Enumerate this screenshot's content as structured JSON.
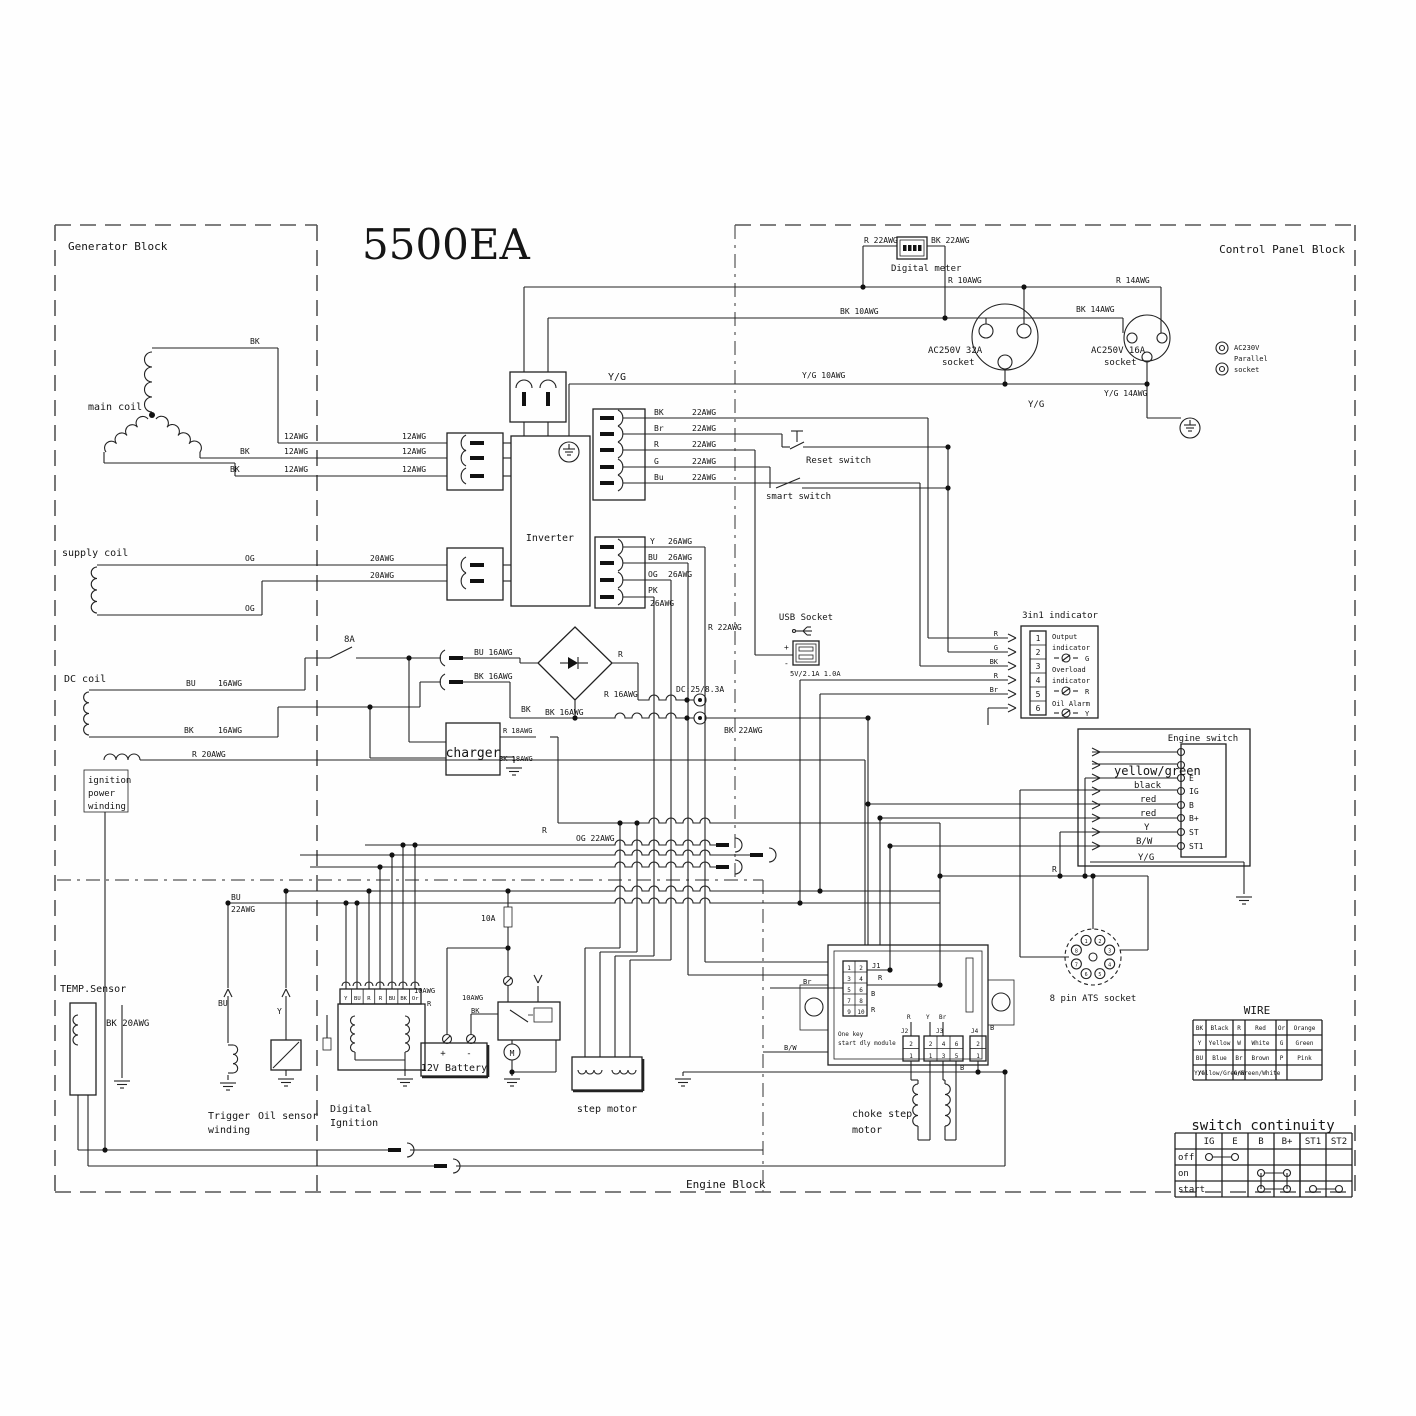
{
  "blocks": {
    "generator": "Generator Block",
    "control_panel": "Control Panel Block",
    "engine": "Engine Block",
    "product": "5500EA"
  },
  "engine_switch": {
    "title": "Engine switch",
    "terminals": [
      "E",
      "IG",
      "B",
      "B+",
      "ST",
      "ST1"
    ],
    "wire_labels": [
      "yellow/green",
      "black",
      "red",
      "red",
      "Y",
      "B/W",
      "Y/G"
    ]
  },
  "indicator": {
    "title": "3in1 indicator",
    "pins": [
      "1",
      "2",
      "3",
      "4",
      "5",
      "6"
    ],
    "wire_labels": [
      "R",
      "G",
      "BK",
      "R",
      "Br"
    ],
    "rows": [
      [
        "Output",
        "indicator"
      ],
      [
        "Overload",
        "indicator"
      ],
      [
        "Oil Alarm"
      ]
    ],
    "leds": [
      "G",
      "R",
      "Y"
    ]
  },
  "module": {
    "name": "One key start dly module",
    "j1_pins": [
      "1",
      "2",
      "3",
      "4",
      "5",
      "6",
      "7",
      "8",
      "9",
      "10"
    ],
    "j2_pins": [
      "2",
      "1"
    ],
    "j3_pins": [
      "2",
      "4",
      "6",
      "1",
      "3",
      "5"
    ],
    "j4_pins": [
      "2",
      "1"
    ]
  },
  "ats": {
    "label": "8 pin ATS socket",
    "pins": [
      "1",
      "2",
      "3",
      "4",
      "5",
      "6",
      "7",
      "8"
    ]
  },
  "ignition": {
    "terminals": [
      "Y",
      "BU",
      "R",
      "R",
      "BU",
      "BK",
      "Or"
    ]
  },
  "wire_table": {
    "title": "WIRE",
    "rows": [
      [
        "BK",
        "Black",
        "R",
        "Red",
        "Or",
        "Orange"
      ],
      [
        "Y",
        "Yellow",
        "W",
        "White",
        "G",
        "Green"
      ],
      [
        "BU",
        "Blue",
        "Br",
        "Brown",
        "P",
        "Pink"
      ],
      [
        "Y/G",
        "Yellow/Green",
        "G/W",
        "Green/White",
        "",
        ""
      ]
    ]
  },
  "continuity_table": {
    "title": "switch continuity",
    "columns": [
      "IG",
      "E",
      "B",
      "B+",
      "ST1",
      "ST2"
    ],
    "rows": [
      "off",
      "on",
      "start"
    ],
    "links": [
      {
        "row": 0,
        "from": "IG",
        "to": "E"
      },
      {
        "row": 1,
        "from": "B",
        "to": "B+"
      },
      {
        "row": 2,
        "from": "B",
        "to": "B+"
      },
      {
        "row": 2,
        "from": "ST1",
        "to": "ST2"
      }
    ],
    "verticals": [
      {
        "col": "B"
      },
      {
        "col": "B+"
      }
    ]
  },
  "labels": [
    {
      "id": "lbl-r22awg-meter",
      "t": "R  22AWG",
      "x": 864,
      "y": 243
    },
    {
      "id": "lbl-bk22awg-meter",
      "t": "BK 22AWG",
      "x": 931,
      "y": 243
    },
    {
      "id": "digital-meter-label",
      "t": "Digital meter",
      "x": 891,
      "y": 271,
      "s": 9
    },
    {
      "id": "lbl-r10awg",
      "t": "R   10AWG",
      "x": 948,
      "y": 283
    },
    {
      "id": "lbl-r14awg",
      "t": "R   14AWG",
      "x": 1116,
      "y": 283
    },
    {
      "id": "lbl-bk10awg",
      "t": "BK   10AWG",
      "x": 840,
      "y": 314
    },
    {
      "id": "lbl-bk14awg",
      "t": "BK   14AWG",
      "x": 1076,
      "y": 312
    },
    {
      "id": "socket32-label1",
      "t": "AC250V 32A",
      "x": 928,
      "y": 353,
      "s": 9
    },
    {
      "id": "socket32-label2",
      "t": "socket",
      "x": 942,
      "y": 365,
      "s": 9
    },
    {
      "id": "socket16-label1",
      "t": "AC250V 16A",
      "x": 1091,
      "y": 353,
      "s": 9
    },
    {
      "id": "socket16-label2",
      "t": "socket",
      "x": 1104,
      "y": 365,
      "s": 9
    },
    {
      "id": "parallel-label1",
      "t": "AC230V",
      "x": 1234,
      "y": 350,
      "s": 7
    },
    {
      "id": "parallel-label2",
      "t": "Parallel",
      "x": 1234,
      "y": 361,
      "s": 7
    },
    {
      "id": "parallel-label3",
      "t": "socket",
      "x": 1234,
      "y": 372,
      "s": 7
    },
    {
      "id": "lbl-yg-inverter",
      "t": "Y/G",
      "x": 608,
      "y": 380,
      "s": 10
    },
    {
      "id": "lbl-yg10awg",
      "t": "Y/G 10AWG",
      "x": 802,
      "y": 378
    },
    {
      "id": "lbl-yg14awg",
      "t": "Y/G 14AWG",
      "x": 1104,
      "y": 396
    },
    {
      "id": "lbl-yg-socket",
      "t": "Y/G",
      "x": 1028,
      "y": 407,
      "s": 9
    },
    {
      "id": "main-coil-label",
      "t": "main coil",
      "x": 88,
      "y": 410,
      "s": 10
    },
    {
      "id": "lbl-bk-main-top",
      "t": "BK",
      "x": 250,
      "y": 344
    },
    {
      "id": "lbl-12awg-1a",
      "t": "12AWG",
      "x": 284,
      "y": 439
    },
    {
      "id": "lbl-12awg-1b",
      "t": "12AWG",
      "x": 402,
      "y": 439
    },
    {
      "id": "lbl-bk-main-2",
      "t": "BK",
      "x": 240,
      "y": 454
    },
    {
      "id": "lbl-12awg-2a",
      "t": "12AWG",
      "x": 284,
      "y": 454
    },
    {
      "id": "lbl-12awg-2b",
      "t": "12AWG",
      "x": 402,
      "y": 454
    },
    {
      "id": "lbl-bk-main-3",
      "t": "BK",
      "x": 230,
      "y": 472
    },
    {
      "id": "lbl-12awg-3a",
      "t": "12AWG",
      "x": 284,
      "y": 472
    },
    {
      "id": "lbl-12awg-3b",
      "t": "12AWG",
      "x": 402,
      "y": 472
    },
    {
      "id": "supply-coil-label",
      "t": "supply coil",
      "x": 62,
      "y": 556,
      "s": 10
    },
    {
      "id": "lbl-og-1",
      "t": "OG",
      "x": 245,
      "y": 561
    },
    {
      "id": "lbl-20awg-1",
      "t": "20AWG",
      "x": 370,
      "y": 561
    },
    {
      "id": "lbl-20awg-2",
      "t": "20AWG",
      "x": 370,
      "y": 578
    },
    {
      "id": "lbl-og-2",
      "t": "OG",
      "x": 245,
      "y": 611
    },
    {
      "id": "lbl-8a",
      "t": "8A",
      "x": 344,
      "y": 642,
      "s": 9
    },
    {
      "id": "dc-coil-label",
      "t": "DC coil",
      "x": 64,
      "y": 682,
      "s": 10
    },
    {
      "id": "lbl-bu-dc",
      "t": "BU",
      "x": 186,
      "y": 686
    },
    {
      "id": "lbl-16awg-dc1",
      "t": "16AWG",
      "x": 218,
      "y": 686
    },
    {
      "id": "lbl-bk-dc",
      "t": "BK",
      "x": 184,
      "y": 733
    },
    {
      "id": "lbl-16awg-dc2",
      "t": "16AWG",
      "x": 218,
      "y": 733
    },
    {
      "id": "lbl-bu16awg",
      "t": "BU  16AWG",
      "x": 474,
      "y": 655
    },
    {
      "id": "lbl-bk16awg-conn",
      "t": "BK  16AWG",
      "x": 474,
      "y": 679
    },
    {
      "id": "lbl-r-bridge",
      "t": "R",
      "x": 618,
      "y": 657
    },
    {
      "id": "lbl-r16awg",
      "t": "R  16AWG",
      "x": 604,
      "y": 697
    },
    {
      "id": "lbl-bk-bridge",
      "t": "BK",
      "x": 521,
      "y": 712
    },
    {
      "id": "lbl-bk16awg-2",
      "t": "BK  16AWG",
      "x": 545,
      "y": 715
    },
    {
      "id": "lbl-dc-rating",
      "t": "DC:25/8.3A",
      "x": 676,
      "y": 692
    },
    {
      "id": "lbl-bk22awg-dc",
      "t": "BK 22AWG",
      "x": 724,
      "y": 733
    },
    {
      "id": "charger-label",
      "t": "charger",
      "x": 473,
      "y": 757,
      "s": 13,
      "a": "middle"
    },
    {
      "id": "lbl-r18awg",
      "t": "R 18AWG",
      "x": 503,
      "y": 733,
      "s": 7
    },
    {
      "id": "lbl-bk18awg",
      "t": "BK 18AWG",
      "x": 499,
      "y": 761,
      "s": 7
    },
    {
      "id": "ignition-winding-1",
      "t": "ignition",
      "x": 88,
      "y": 783,
      "s": 9
    },
    {
      "id": "ignition-winding-2",
      "t": "power",
      "x": 88,
      "y": 796,
      "s": 9
    },
    {
      "id": "ignition-winding-3",
      "t": "winding",
      "x": 88,
      "y": 809,
      "s": 9
    },
    {
      "id": "lbl-r20awg",
      "t": "R   20AWG",
      "x": 192,
      "y": 757
    },
    {
      "id": "lbl-og22awg",
      "t": "OG  22AWG",
      "x": 576,
      "y": 841
    },
    {
      "id": "lbl-r-bundle",
      "t": "R",
      "x": 542,
      "y": 833
    },
    {
      "id": "lbl-10a",
      "t": "10A",
      "x": 481,
      "y": 921
    },
    {
      "id": "usb-title",
      "t": "USB Socket",
      "x": 806,
      "y": 620,
      "s": 9,
      "a": "middle"
    },
    {
      "id": "lbl-r22awg-usb",
      "t": "R  22AWG",
      "x": 708,
      "y": 630
    },
    {
      "id": "usb-rating",
      "t": "5V/2.1A 1.0A",
      "x": 790,
      "y": 676,
      "s": 7
    },
    {
      "id": "usb-plus",
      "t": "+",
      "x": 784,
      "y": 650,
      "s": 8
    },
    {
      "id": "usb-minus",
      "t": "-",
      "x": 784,
      "y": 666,
      "s": 8
    },
    {
      "id": "lbl-r-ats",
      "t": "R",
      "x": 1052,
      "y": 872
    },
    {
      "id": "ats-label",
      "t": "8 pin ATS socket",
      "x": 1093,
      "y": 1001,
      "s": 9,
      "a": "middle"
    },
    {
      "id": "temp-sensor-label",
      "t": "TEMP.Sensor",
      "x": 60,
      "y": 992,
      "s": 10
    },
    {
      "id": "lbl-bk20awg",
      "t": "BK  20AWG",
      "x": 106,
      "y": 1026,
      "s": 9
    },
    {
      "id": "lbl-bu-trigger",
      "t": "BU",
      "x": 218,
      "y": 1006
    },
    {
      "id": "lbl-y-oil",
      "t": "Y",
      "x": 277,
      "y": 1014
    },
    {
      "id": "trigger-label-1",
      "t": "Trigger",
      "x": 208,
      "y": 1119,
      "s": 10
    },
    {
      "id": "trigger-label-2",
      "t": "winding",
      "x": 208,
      "y": 1133,
      "s": 10
    },
    {
      "id": "oil-sensor-label",
      "t": "Oil sensor",
      "x": 258,
      "y": 1119,
      "s": 10
    },
    {
      "id": "digital-ignition-label-1",
      "t": "Digital",
      "x": 330,
      "y": 1112,
      "s": 10
    },
    {
      "id": "digital-ignition-label-2",
      "t": "Ignition",
      "x": 330,
      "y": 1126,
      "s": 10
    },
    {
      "id": "lbl-10awg-batt",
      "t": "10AWG",
      "x": 414,
      "y": 993,
      "s": 7
    },
    {
      "id": "lbl-r-batt",
      "t": "R",
      "x": 427,
      "y": 1006,
      "s": 7
    },
    {
      "id": "lbl-10awg-relay",
      "t": "10AWG",
      "x": 462,
      "y": 1000,
      "s": 7
    },
    {
      "id": "lbl-bk-relay",
      "t": "BK",
      "x": 471,
      "y": 1013,
      "s": 7
    },
    {
      "id": "battery-plus",
      "t": "+",
      "x": 443,
      "y": 1056,
      "s": 9,
      "a": "middle"
    },
    {
      "id": "battery-minus",
      "t": "-",
      "x": 469,
      "y": 1056,
      "s": 9,
      "a": "middle"
    },
    {
      "id": "battery-label",
      "t": "12V Battery",
      "x": 454,
      "y": 1071,
      "s": 10,
      "a": "middle"
    },
    {
      "id": "motor-m",
      "t": "M",
      "x": 512,
      "y": 1056,
      "s": 8,
      "a": "middle"
    },
    {
      "id": "step-motor-label",
      "t": "step motor",
      "x": 607,
      "y": 1112,
      "s": 10,
      "a": "middle"
    },
    {
      "id": "choke-label-1",
      "t": "choke step",
      "x": 852,
      "y": 1117,
      "s": 10
    },
    {
      "id": "choke-label-2",
      "t": "motor",
      "x": 852,
      "y": 1133,
      "s": 10
    },
    {
      "id": "onekey-label-1",
      "t": "One key",
      "x": 838,
      "y": 1036,
      "s": 6
    },
    {
      "id": "onekey-label-2",
      "t": "start dly module",
      "x": 838,
      "y": 1045,
      "s": 6
    },
    {
      "id": "lbl-j1",
      "t": "J1",
      "x": 872,
      "y": 968,
      "s": 7
    },
    {
      "id": "lbl-j1-r1",
      "t": "R",
      "x": 878,
      "y": 980,
      "s": 7
    },
    {
      "id": "lbl-j1-b",
      "t": "B",
      "x": 871,
      "y": 996,
      "s": 7
    },
    {
      "id": "lbl-j1-r2",
      "t": "R",
      "x": 871,
      "y": 1012,
      "s": 7
    },
    {
      "id": "lbl-br-module",
      "t": "Br",
      "x": 803,
      "y": 984,
      "s": 7
    },
    {
      "id": "lbl-bw-module",
      "t": "B/W",
      "x": 784,
      "y": 1050,
      "s": 7
    },
    {
      "id": "lbl-j2",
      "t": "J2",
      "x": 901,
      "y": 1033,
      "s": 6
    },
    {
      "id": "lbl-j3",
      "t": "J3",
      "x": 936,
      "y": 1033,
      "s": 6
    },
    {
      "id": "lbl-j4",
      "t": "J4",
      "x": 971,
      "y": 1033,
      "s": 6
    },
    {
      "id": "lbl-r-conn",
      "t": "R",
      "x": 907,
      "y": 1019,
      "s": 6
    },
    {
      "id": "lbl-y-conn",
      "t": "Y",
      "x": 926,
      "y": 1019,
      "s": 6
    },
    {
      "id": "lbl-br-conn",
      "t": "Br",
      "x": 939,
      "y": 1019,
      "s": 6
    },
    {
      "id": "lbl-b-conn1",
      "t": "B",
      "x": 990,
      "y": 1030,
      "s": 7
    },
    {
      "id": "lbl-b-conn2",
      "t": "B",
      "x": 960,
      "y": 1070,
      "s": 7
    },
    {
      "id": "lbl-bu22-1",
      "t": "BU",
      "x": 231,
      "y": 900
    },
    {
      "id": "lbl-bu22-2",
      "t": "22AWG",
      "x": 231,
      "y": 912
    },
    {
      "id": "inverter-label",
      "t": "Inverter",
      "x": 550,
      "y": 541,
      "s": 10,
      "a": "middle"
    },
    {
      "id": "lbl-w1c",
      "t": "BK",
      "x": 654,
      "y": 415
    },
    {
      "id": "lbl-w1g",
      "t": "22AWG",
      "x": 692,
      "y": 415
    },
    {
      "id": "lbl-w2c",
      "t": "Br",
      "x": 654,
      "y": 431
    },
    {
      "id": "lbl-w2g",
      "t": "22AWG",
      "x": 692,
      "y": 431
    },
    {
      "id": "lbl-w3c",
      "t": "R",
      "x": 654,
      "y": 447
    },
    {
      "id": "lbl-w3g",
      "t": "22AWG",
      "x": 692,
      "y": 447
    },
    {
      "id": "lbl-w4c",
      "t": "G",
      "x": 654,
      "y": 464
    },
    {
      "id": "lbl-w4g",
      "t": "22AWG",
      "x": 692,
      "y": 464
    },
    {
      "id": "lbl-w5c",
      "t": "Bu",
      "x": 654,
      "y": 480
    },
    {
      "id": "lbl-w5g",
      "t": "22AWG",
      "x": 692,
      "y": 480
    },
    {
      "id": "lbl-s1c",
      "t": "Y",
      "x": 650,
      "y": 544
    },
    {
      "id": "lbl-s1g",
      "t": "26AWG",
      "x": 668,
      "y": 544
    },
    {
      "id": "lbl-s2c",
      "t": "BU",
      "x": 648,
      "y": 560
    },
    {
      "id": "lbl-s2g",
      "t": "26AWG",
      "x": 668,
      "y": 560
    },
    {
      "id": "lbl-s3c",
      "t": "OG",
      "x": 648,
      "y": 577
    },
    {
      "id": "lbl-s3g",
      "t": "26AWG",
      "x": 668,
      "y": 577
    },
    {
      "id": "lbl-s4c",
      "t": "PK",
      "x": 648,
      "y": 593
    },
    {
      "id": "lbl-s4g",
      "t": "26AWG",
      "x": 650,
      "y": 606
    },
    {
      "id": "reset-switch-label",
      "t": "Reset switch",
      "x": 806,
      "y": 463,
      "s": 9
    },
    {
      "id": "smart-switch-label",
      "t": "smart switch",
      "x": 766,
      "y": 499,
      "s": 9
    }
  ]
}
